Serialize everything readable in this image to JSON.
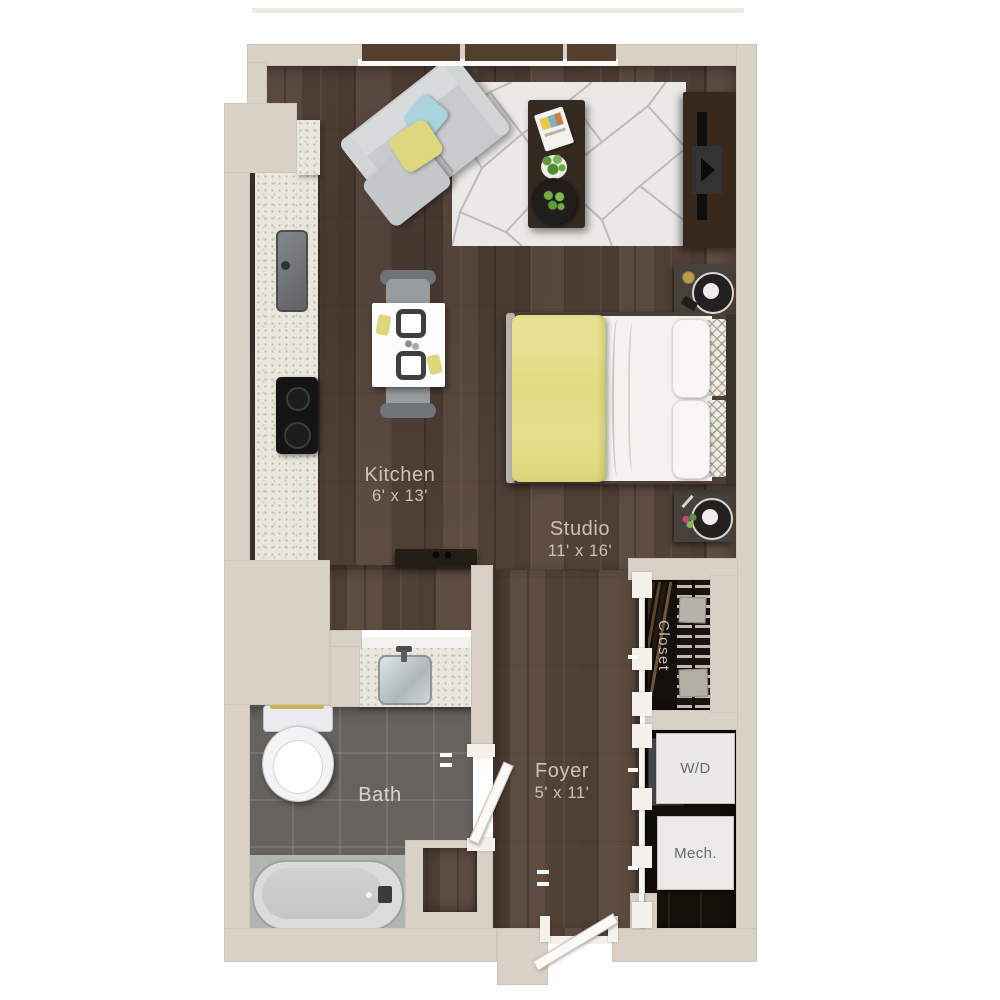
{
  "rooms": {
    "kitchen": {
      "label": "Kitchen",
      "dims": "6' x 13'"
    },
    "studio": {
      "label": "Studio",
      "dims": "11' x 16'"
    },
    "bath": {
      "label": "Bath"
    },
    "foyer": {
      "label": "Foyer",
      "dims": "5' x 11'"
    },
    "closet": {
      "label": "Closet"
    },
    "laundry": {
      "label": "W/D"
    },
    "mechanical": {
      "label": "Mech."
    }
  },
  "colors": {
    "wall": "#d9d1c5",
    "wood_floor": "#57453a",
    "bath_tile": "#67625d",
    "counter": "#e9e6dc",
    "closet_interior": "#16100b",
    "bed_blanket_yellow": "#e4dd86",
    "sofa_gray": "#c7cbcd",
    "label_text": "#c9c3ba"
  }
}
